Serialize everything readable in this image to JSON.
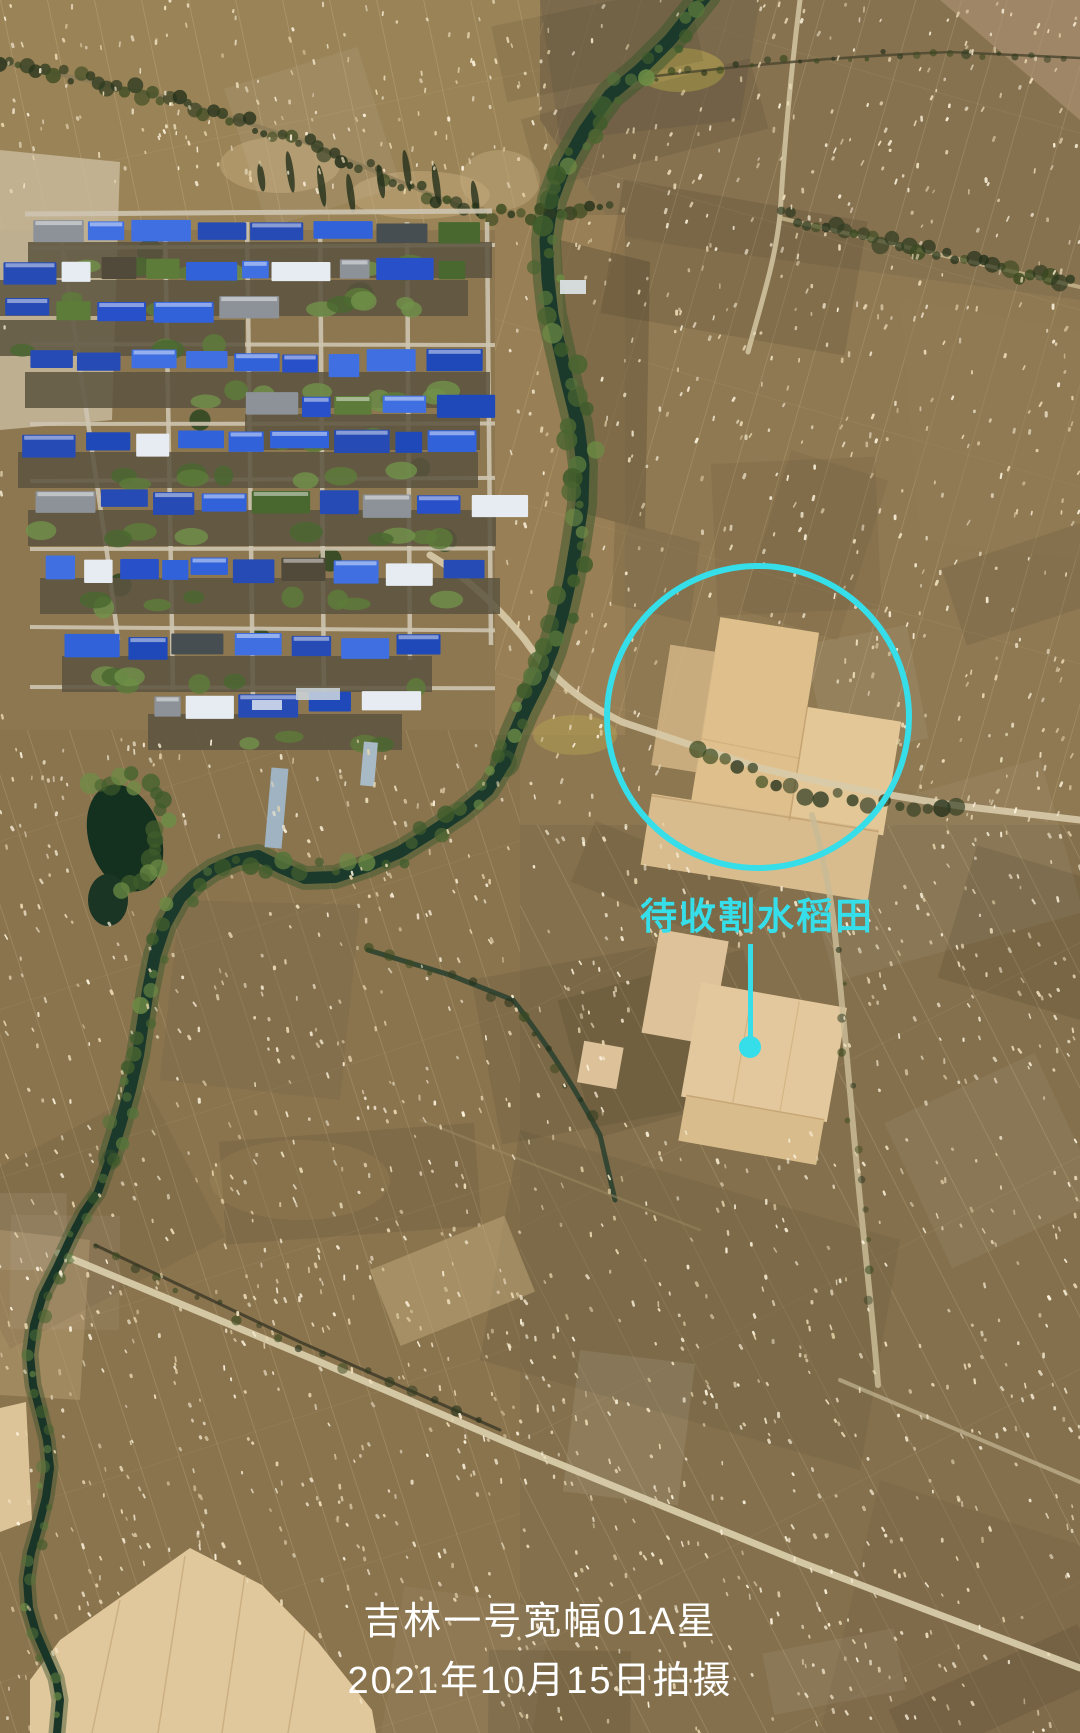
{
  "annotation": {
    "label": "待收割水稻田",
    "color": "#35DEE9",
    "circle": {
      "cx": 758,
      "cy": 717,
      "r": 151,
      "stroke_width": 6
    },
    "pointer": {
      "x": 750,
      "line_top": 944,
      "line_bottom": 1040,
      "dot_cx": 750,
      "dot_cy": 1047,
      "dot_r": 11
    },
    "label_cx": 757,
    "label_top": 886,
    "font_size": 37
  },
  "caption": {
    "line1": "吉林一号宽幅01A星",
    "line2": "2021年10月15日拍摄",
    "color": "#FFFFFF",
    "cx": 540,
    "line1_top": 1590,
    "line2_top": 1649,
    "font_size": 38
  }
}
